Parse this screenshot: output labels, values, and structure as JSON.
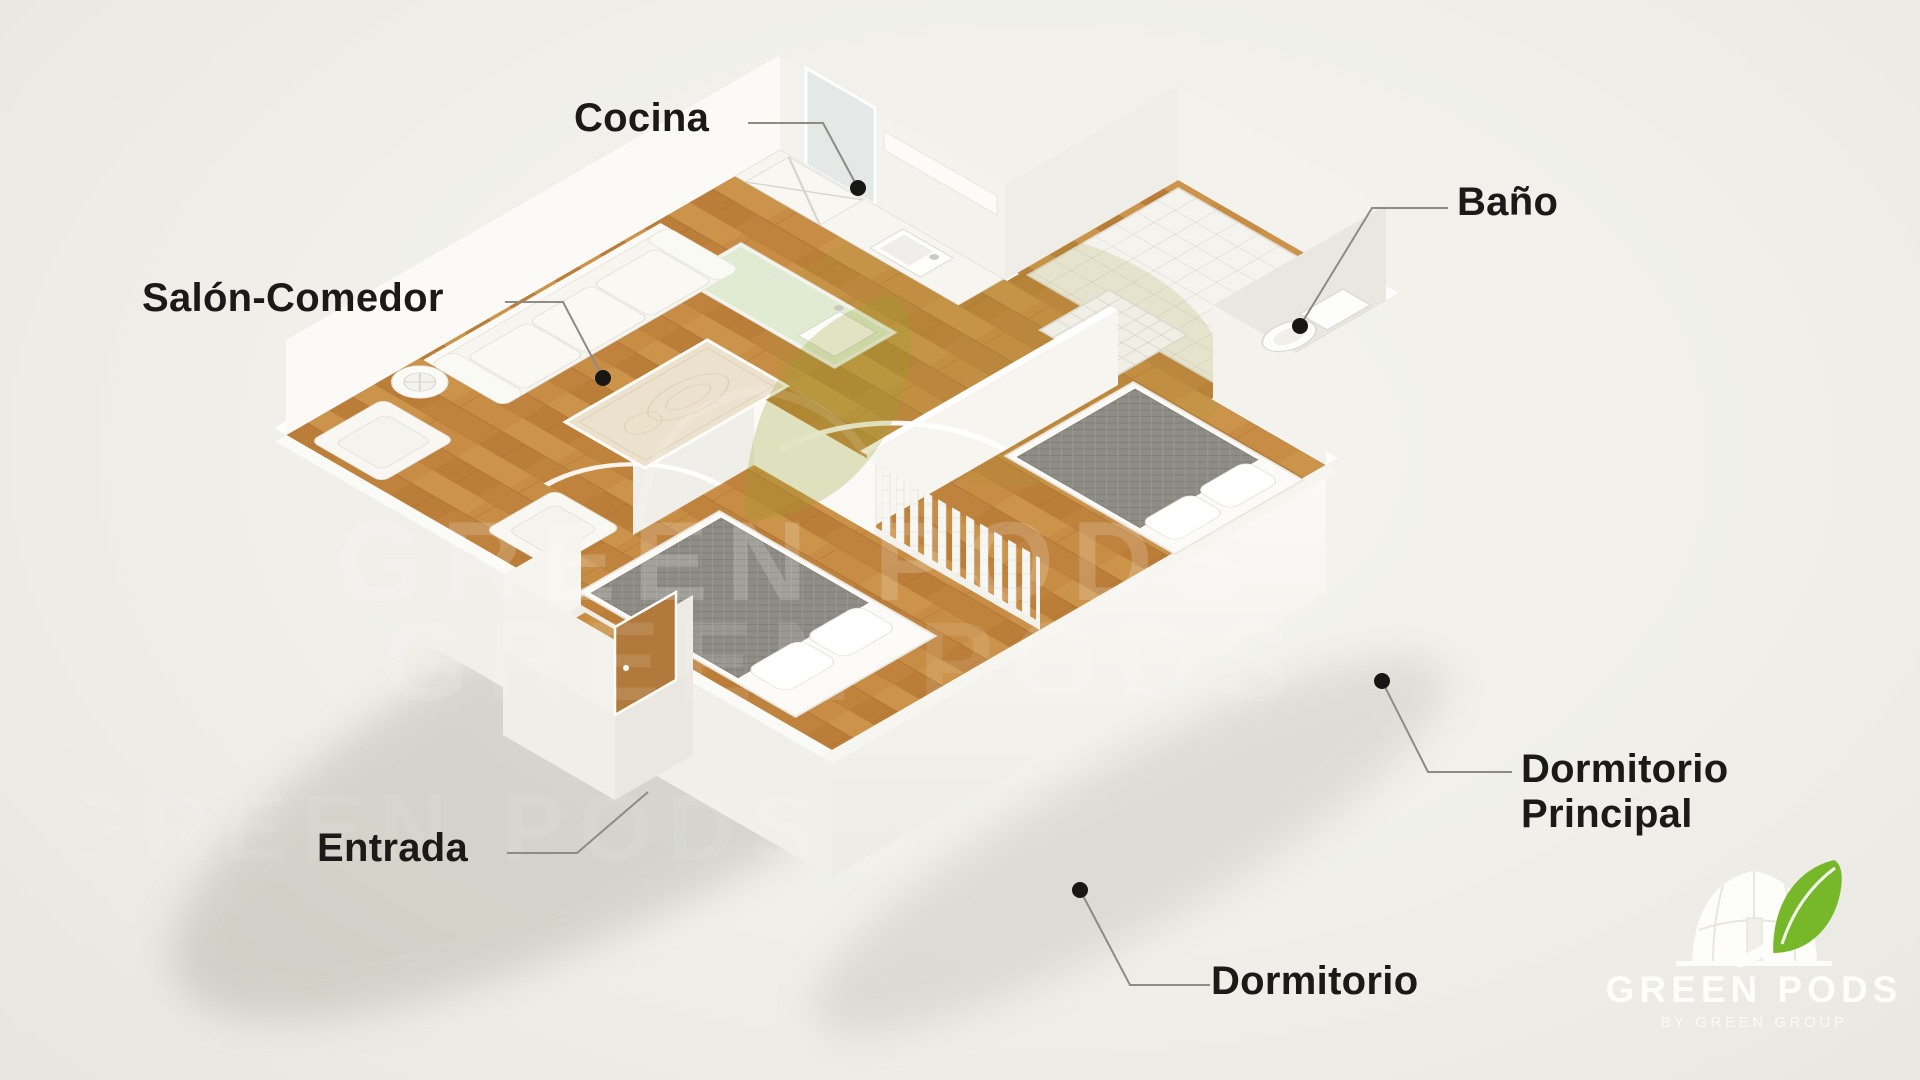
{
  "floorplan": {
    "labels": {
      "cocina": "Cocina",
      "salon_comedor": "Salón-Comedor",
      "bano": "Baño",
      "entrada": "Entrada",
      "dormitorio_principal": "Dormitorio Principal",
      "dormitorio": "Dormitorio"
    }
  },
  "watermark": {
    "text": "GREEN PODS"
  },
  "logo": {
    "name": "GREEN PODS",
    "tagline": "BY GREEN GROUP"
  },
  "colors": {
    "background": "#f0efe9",
    "label_text": "#1b1a18",
    "connector_line": "#8e8b84",
    "marker_dot": "#181715",
    "wall_white": "#f7f6f2",
    "floor_wood": "#c2853e",
    "bathroom_tile": "#f4f3ee",
    "counter_mint": "#dfecd2",
    "bed_fabric": "#8e8d85",
    "logo_leaf_green": "#76b82a",
    "logo_text_white": "#fdfdf9"
  }
}
